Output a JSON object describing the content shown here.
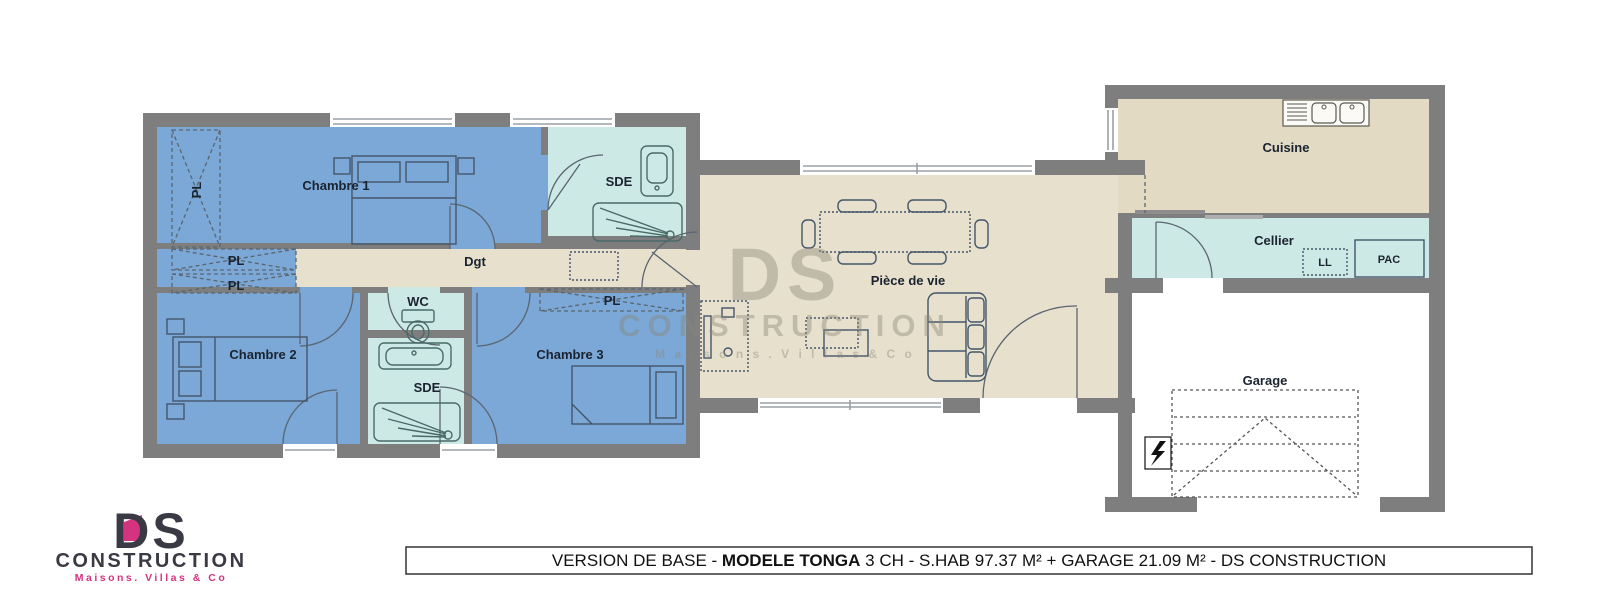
{
  "labels": {
    "chambre1": "Chambre 1",
    "chambre2": "Chambre 2",
    "chambre3": "Chambre 3",
    "sde": "SDE",
    "wc": "WC",
    "dgt": "Dgt",
    "piece_de_vie": "Pièce de vie",
    "cuisine": "Cuisine",
    "cellier": "Cellier",
    "garage": "Garage",
    "pl": "PL",
    "ll": "LL",
    "pac": "PAC"
  },
  "watermark": {
    "ds": "DS",
    "construction": "CONSTRUCTION",
    "tagline": "M a i s o n s .   V i l l a s   &   C o"
  },
  "logo": {
    "ds": "DS",
    "construction": "CONSTRUCTION",
    "tagline": "Maisons. Villas & Co"
  },
  "title_bar": {
    "part1": "VERSION DE BASE - ",
    "part2_bold": "MODELE TONGA",
    "part3": " 3 CH - S.HAB 97.37 M² + GARAGE 21.09 M² - DS CONSTRUCTION"
  },
  "colors": {
    "wall": "#7e7e7e",
    "bedroom": "#7ba8d6",
    "bathroom": "#cde9e6",
    "living": "#e7e0cc",
    "kitchen": "#e2dac2",
    "garage_floor": "#ffffff",
    "logo_pink": "#d4337f",
    "logo_dark": "#3a3a44",
    "watermark": "#8b8678"
  }
}
